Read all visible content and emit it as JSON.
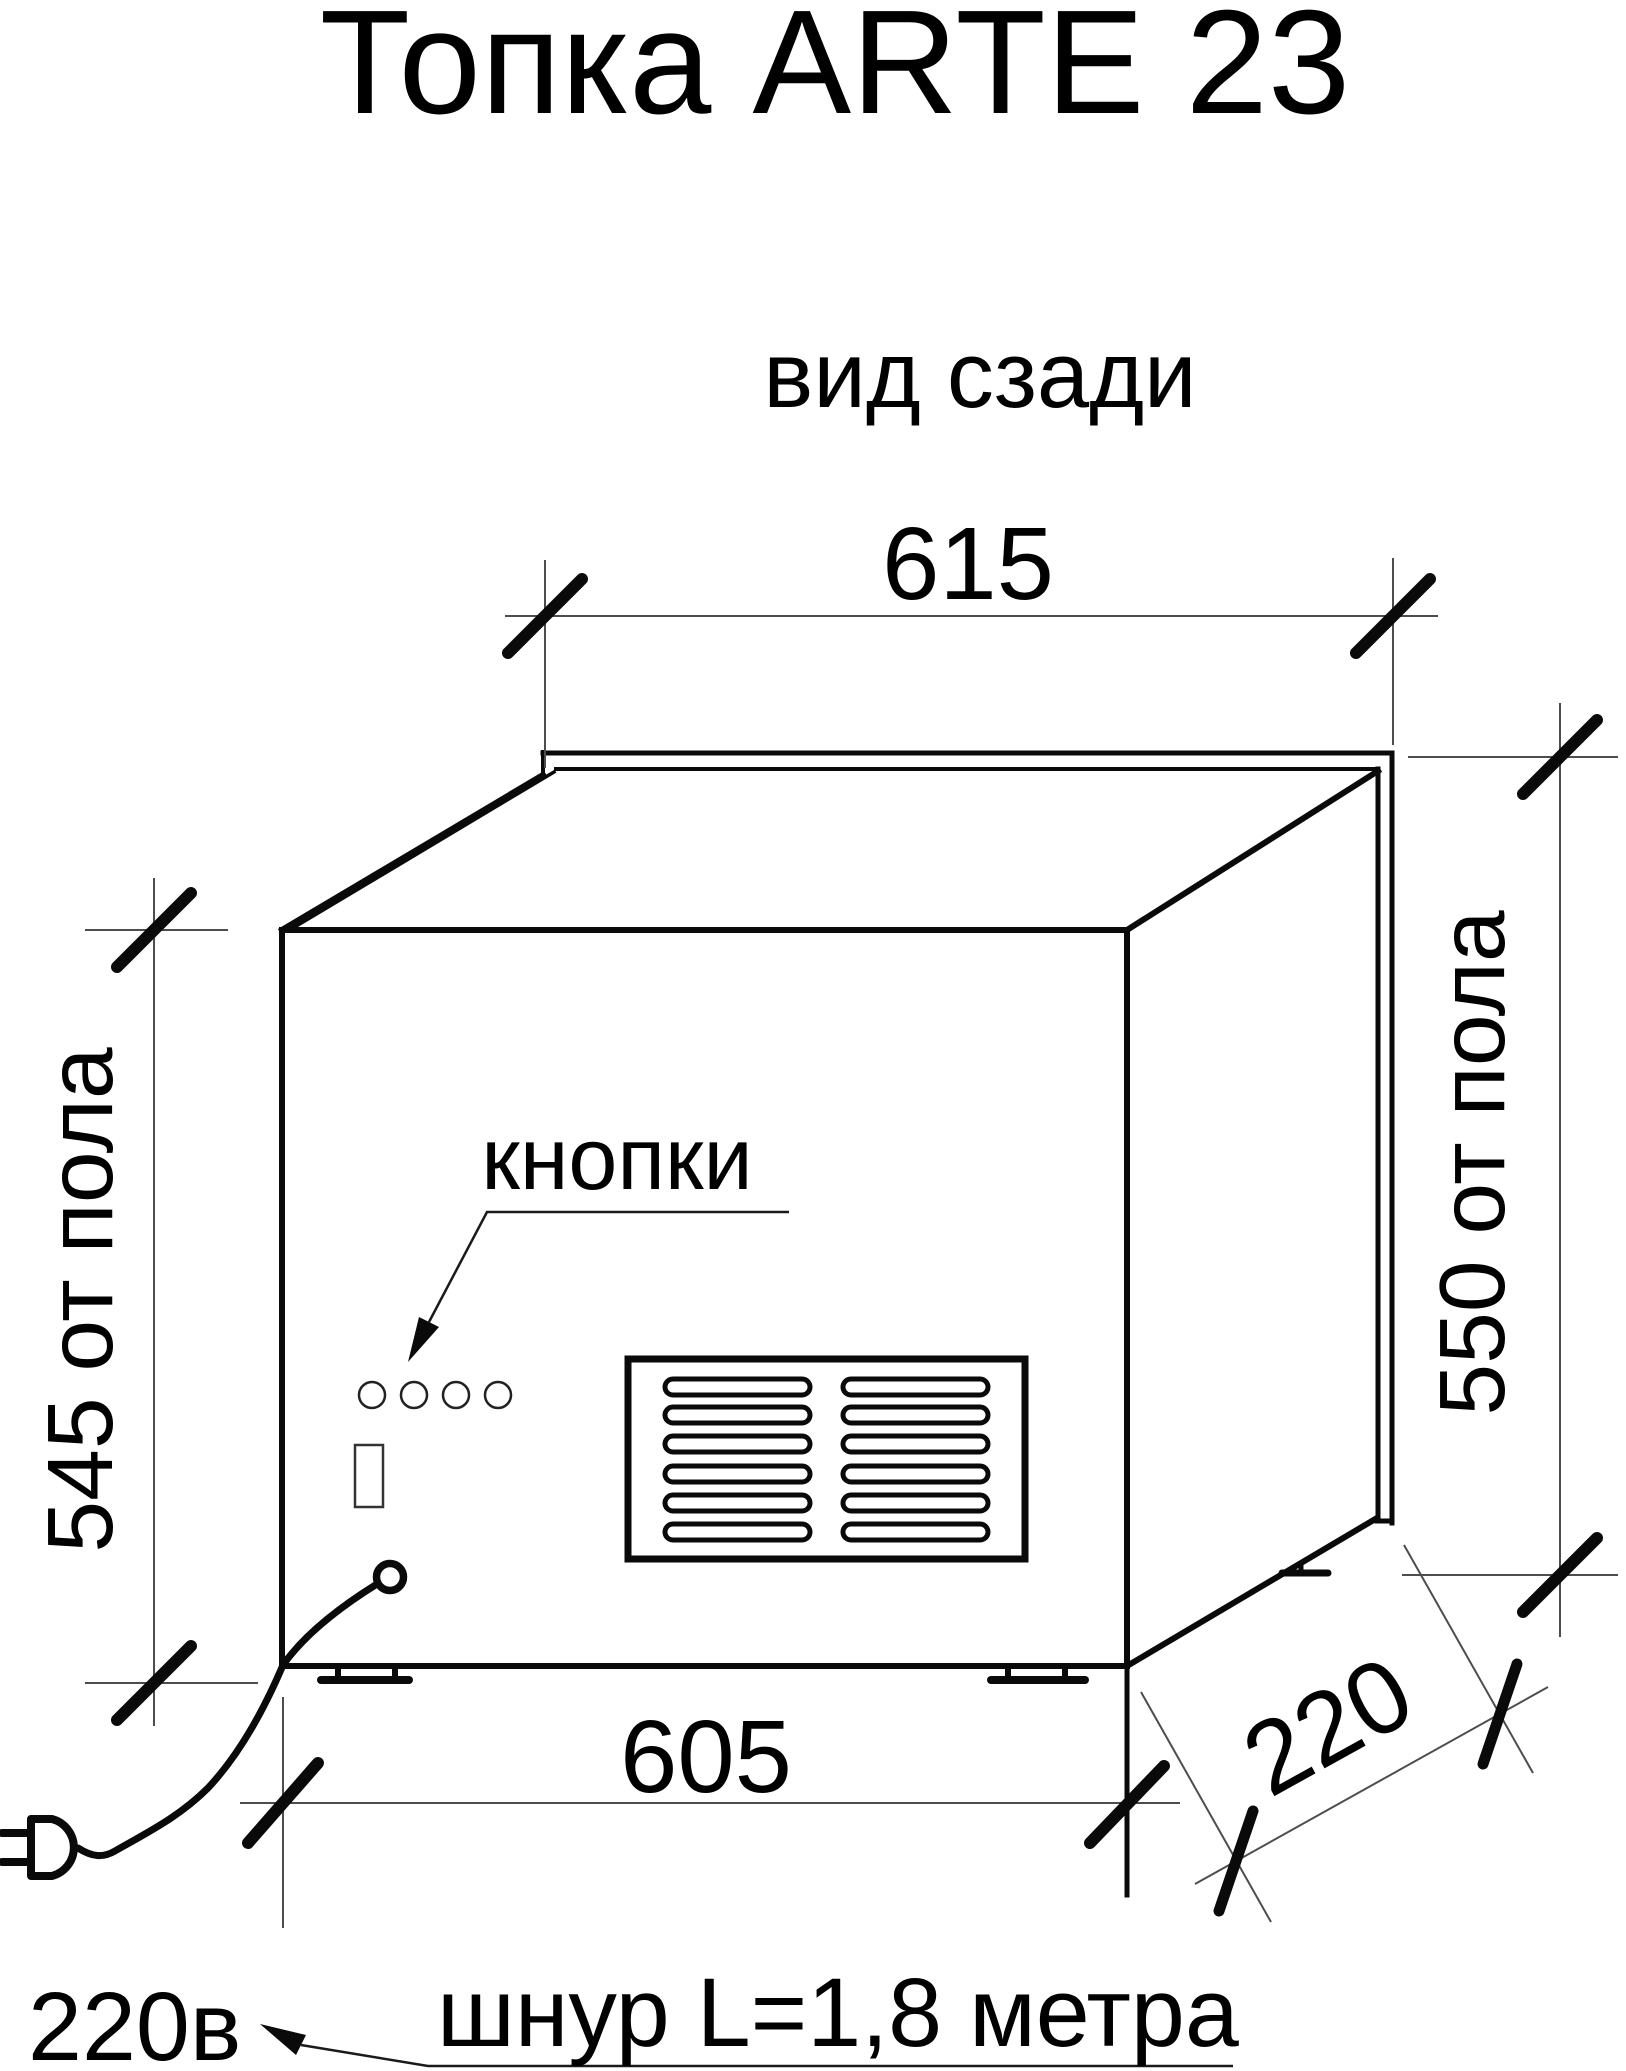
{
  "title": "Топка ARTE 23",
  "view_label": "вид сзади",
  "dims": {
    "top": "615",
    "bottom": "605",
    "left": "545 от пола",
    "right": "550 от пола",
    "depth": "220"
  },
  "labels": {
    "buttons": "кнопки",
    "power": "220в",
    "cord": "шнур L=1,8 метра"
  }
}
